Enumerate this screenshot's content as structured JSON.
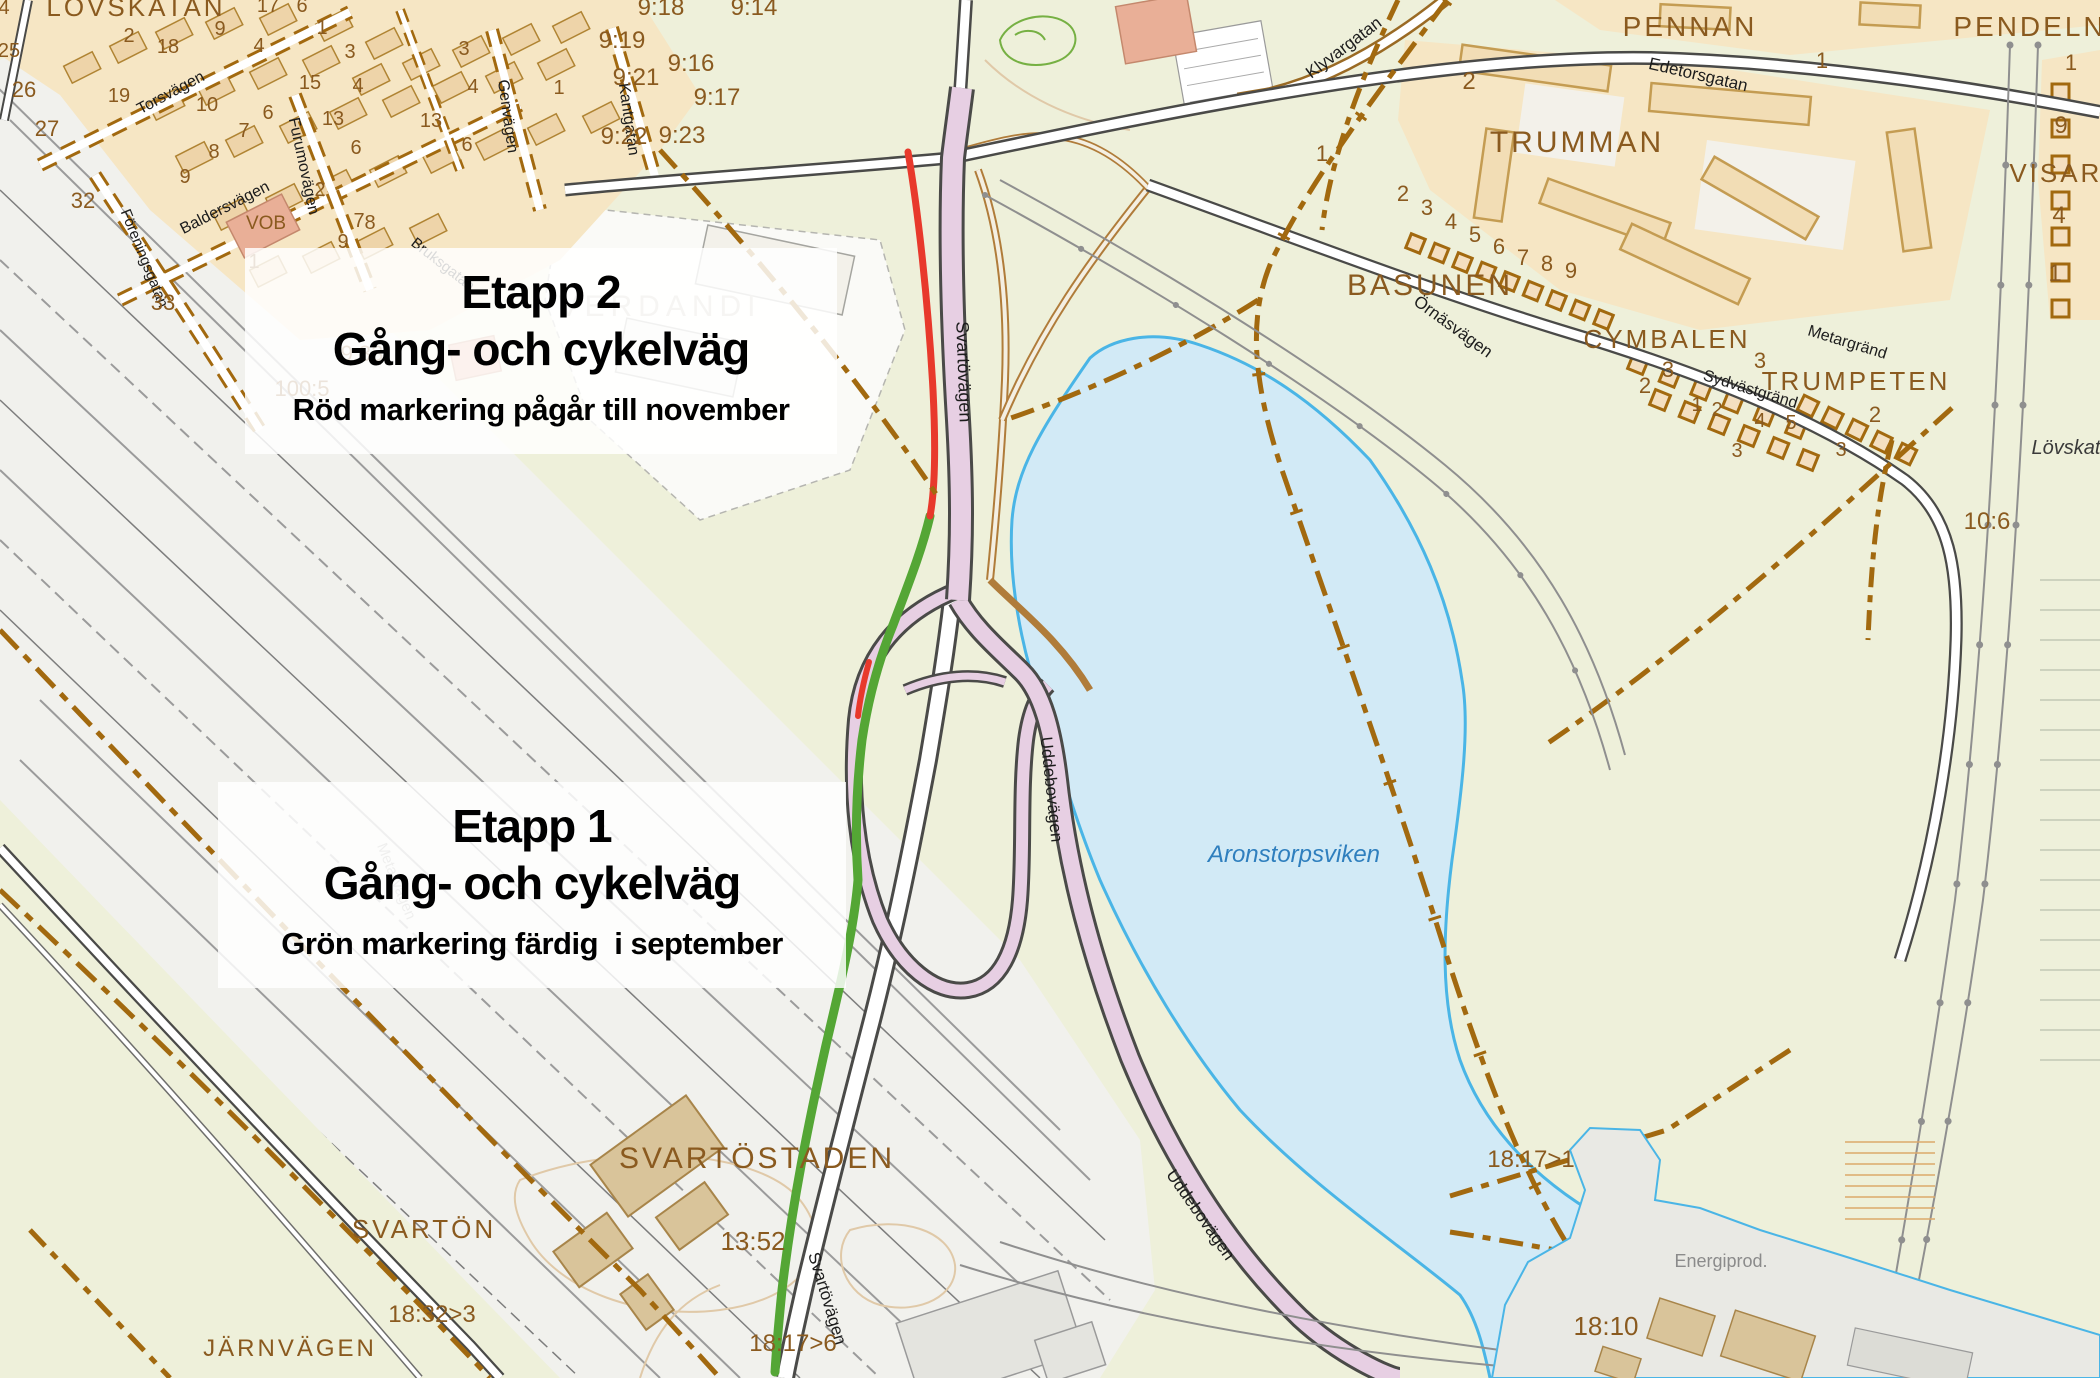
{
  "etapp2_box": {
    "title": "Etapp 2",
    "subtitle": "Gång- och cykelväg",
    "detail": "Röd markering pågår till november"
  },
  "etapp1_box": {
    "title": "Etapp 1",
    "subtitle": "Gång- och cykelväg",
    "detail": "Grön markering färdig  i september"
  },
  "markings": {
    "etapp1_green": "#54a635",
    "etapp2_red": "#e8392c",
    "water_fill": "#d2eaf6",
    "water_edge": "#4ab5e6",
    "road_pink": "#e7cfe3",
    "cadastral_brown": "#a2690f"
  },
  "map": {
    "labels": [
      {
        "text": "LÖVSKATAN",
        "x": 136,
        "y": 16,
        "r": 0,
        "s": 26,
        "c": "place"
      },
      {
        "text": "VERDANDI",
        "x": 660,
        "y": 316,
        "r": 0,
        "s": 30,
        "c": "place-gray"
      },
      {
        "text": "SVARTÖSTADEN",
        "x": 757,
        "y": 1168,
        "r": 0,
        "s": 30,
        "c": "place"
      },
      {
        "text": "SVARTÖN",
        "x": 424,
        "y": 1238,
        "r": 0,
        "s": 26,
        "c": "place"
      },
      {
        "text": "JÄRNVÄGEN",
        "x": 290,
        "y": 1356,
        "r": 0,
        "s": 24,
        "c": "place"
      },
      {
        "text": "TRUMMAN",
        "x": 1577,
        "y": 152,
        "r": 0,
        "s": 30,
        "c": "place"
      },
      {
        "text": "PENNAN",
        "x": 1690,
        "y": 36,
        "r": 0,
        "s": 28,
        "c": "place"
      },
      {
        "text": "PENDELN",
        "x": 2030,
        "y": 36,
        "r": 0,
        "s": 28,
        "c": "place"
      },
      {
        "text": "VISARE",
        "x": 2066,
        "y": 182,
        "r": 0,
        "s": 26,
        "c": "place"
      },
      {
        "text": "BASUNEN",
        "x": 1430,
        "y": 295,
        "r": 0,
        "s": 30,
        "c": "place"
      },
      {
        "text": "CYMBALEN",
        "x": 1667,
        "y": 348,
        "r": 0,
        "s": 26,
        "c": "place"
      },
      {
        "text": "TRUMPETEN",
        "x": 1856,
        "y": 390,
        "r": 0,
        "s": 26,
        "c": "place"
      },
      {
        "text": "Aronstorpsviken",
        "x": 1294,
        "y": 862,
        "r": 0,
        "s": 24,
        "c": "water"
      },
      {
        "text": "Energiprod.",
        "x": 1721,
        "y": 1267,
        "r": 0,
        "s": 18,
        "c": "gray"
      },
      {
        "text": "Lövskat",
        "x": 2066,
        "y": 454,
        "r": 0,
        "s": 20,
        "c": "it"
      },
      {
        "text": "Svartövägen",
        "x": 958,
        "y": 372,
        "r": 88,
        "s": 18,
        "c": "street"
      },
      {
        "text": "Svartövägen",
        "x": 822,
        "y": 1300,
        "r": 73,
        "s": 17,
        "c": "street"
      },
      {
        "text": "Uddebovägen",
        "x": 1046,
        "y": 790,
        "r": 84,
        "s": 17,
        "c": "street"
      },
      {
        "text": "Uddebovägen",
        "x": 1196,
        "y": 1218,
        "r": 55,
        "s": 17,
        "c": "street"
      },
      {
        "text": "Klyvargatan",
        "x": 1347,
        "y": 52,
        "r": -37,
        "s": 17,
        "c": "street"
      },
      {
        "text": "Edetorsgatan",
        "x": 1697,
        "y": 80,
        "r": 13,
        "s": 17,
        "c": "street"
      },
      {
        "text": "Örnäsvägen",
        "x": 1450,
        "y": 331,
        "r": 36,
        "s": 17,
        "c": "street"
      },
      {
        "text": "Metargränd",
        "x": 1846,
        "y": 347,
        "r": 17,
        "s": 16,
        "c": "street"
      },
      {
        "text": "Sydvästgränd",
        "x": 1749,
        "y": 394,
        "r": 17,
        "s": 16,
        "c": "street"
      },
      {
        "text": "Genvägen",
        "x": 503,
        "y": 117,
        "r": 82,
        "s": 16,
        "c": "street"
      },
      {
        "text": "Kantgatan",
        "x": 624,
        "y": 120,
        "r": 82,
        "s": 16,
        "c": "street"
      },
      {
        "text": "Furumovägen",
        "x": 299,
        "y": 167,
        "r": 78,
        "s": 16,
        "c": "street"
      },
      {
        "text": "Baldersvägen",
        "x": 227,
        "y": 212,
        "r": -27,
        "s": 16,
        "c": "street"
      },
      {
        "text": "Torsvägen",
        "x": 173,
        "y": 97,
        "r": -28,
        "s": 16,
        "c": "street"
      },
      {
        "text": "Föreningsgatan",
        "x": 140,
        "y": 260,
        "r": 68,
        "s": 15,
        "c": "street"
      },
      {
        "text": "Bruksgatan",
        "x": 440,
        "y": 268,
        "r": 38,
        "s": 15,
        "c": "street"
      },
      {
        "text": "Metallvägen",
        "x": 392,
        "y": 883,
        "r": 68,
        "s": 15,
        "c": "street-gray"
      },
      {
        "text": "9:18",
        "x": 661,
        "y": 15,
        "r": 0,
        "s": 24,
        "c": "parcel"
      },
      {
        "text": "9:14",
        "x": 754,
        "y": 15,
        "r": 0,
        "s": 24,
        "c": "parcel"
      },
      {
        "text": "9:19",
        "x": 622,
        "y": 48,
        "r": 0,
        "s": 24,
        "c": "parcel"
      },
      {
        "text": "9:16",
        "x": 691,
        "y": 71,
        "r": 0,
        "s": 24,
        "c": "parcel"
      },
      {
        "text": "9:21",
        "x": 636,
        "y": 85,
        "r": 0,
        "s": 24,
        "c": "parcel"
      },
      {
        "text": "9:17",
        "x": 717,
        "y": 105,
        "r": 0,
        "s": 24,
        "c": "parcel"
      },
      {
        "text": "9:22",
        "x": 624,
        "y": 144,
        "r": 0,
        "s": 24,
        "c": "parcel"
      },
      {
        "text": "9:23",
        "x": 682,
        "y": 143,
        "r": 0,
        "s": 24,
        "c": "parcel"
      },
      {
        "text": "9:33",
        "x": 362,
        "y": 361,
        "r": 0,
        "s": 22,
        "c": "parcel"
      },
      {
        "text": "100:5",
        "x": 302,
        "y": 396,
        "r": 0,
        "s": 22,
        "c": "parcel"
      },
      {
        "text": "33",
        "x": 163,
        "y": 310,
        "r": 0,
        "s": 22,
        "c": "parcel"
      },
      {
        "text": "10:6",
        "x": 1987,
        "y": 529,
        "r": 0,
        "s": 24,
        "c": "parcel"
      },
      {
        "text": "13:52",
        "x": 753,
        "y": 1250,
        "r": 0,
        "s": 26,
        "c": "parcel"
      },
      {
        "text": "18:32>3",
        "x": 432,
        "y": 1322,
        "r": 0,
        "s": 24,
        "c": "parcel"
      },
      {
        "text": "18:17>1",
        "x": 1531,
        "y": 1167,
        "r": 0,
        "s": 24,
        "c": "parcel"
      },
      {
        "text": "18:10",
        "x": 1606,
        "y": 1335,
        "r": 0,
        "s": 26,
        "c": "parcel"
      },
      {
        "text": "18:17>6",
        "x": 793,
        "y": 1351,
        "r": 0,
        "s": 24,
        "c": "parcel"
      },
      {
        "text": "VOB",
        "x": 266,
        "y": 229,
        "r": 0,
        "s": 19,
        "c": "num"
      },
      {
        "text": "4",
        "x": 4,
        "y": 14,
        "r": 0,
        "s": 20,
        "c": "num"
      },
      {
        "text": "25",
        "x": 9,
        "y": 57,
        "r": 0,
        "s": 20,
        "c": "num"
      },
      {
        "text": "26",
        "x": 24,
        "y": 97,
        "r": 0,
        "s": 22,
        "c": "num"
      },
      {
        "text": "27",
        "x": 47,
        "y": 136,
        "r": 0,
        "s": 22,
        "c": "num"
      },
      {
        "text": "32",
        "x": 83,
        "y": 208,
        "r": 0,
        "s": 22,
        "c": "num"
      },
      {
        "text": "19",
        "x": 119,
        "y": 102,
        "r": 0,
        "s": 20,
        "c": "num"
      },
      {
        "text": "2",
        "x": 129,
        "y": 42,
        "r": 0,
        "s": 20,
        "c": "num"
      },
      {
        "text": "18",
        "x": 168,
        "y": 53,
        "r": 0,
        "s": 20,
        "c": "num"
      },
      {
        "text": "17",
        "x": 268,
        "y": 12,
        "r": 0,
        "s": 20,
        "c": "num"
      },
      {
        "text": "6",
        "x": 302,
        "y": 12,
        "r": 0,
        "s": 20,
        "c": "num"
      },
      {
        "text": "9",
        "x": 220,
        "y": 35,
        "r": 0,
        "s": 20,
        "c": "num"
      },
      {
        "text": "1",
        "x": 322,
        "y": 34,
        "r": 0,
        "s": 20,
        "c": "num"
      },
      {
        "text": "3",
        "x": 350,
        "y": 58,
        "r": 0,
        "s": 20,
        "c": "num"
      },
      {
        "text": "4",
        "x": 259,
        "y": 52,
        "r": 0,
        "s": 20,
        "c": "num"
      },
      {
        "text": "10",
        "x": 207,
        "y": 111,
        "r": 0,
        "s": 20,
        "c": "num"
      },
      {
        "text": "15",
        "x": 310,
        "y": 89,
        "r": 0,
        "s": 20,
        "c": "num"
      },
      {
        "text": "4",
        "x": 358,
        "y": 92,
        "r": 0,
        "s": 20,
        "c": "num"
      },
      {
        "text": "13",
        "x": 333,
        "y": 125,
        "r": 0,
        "s": 20,
        "c": "num"
      },
      {
        "text": "6",
        "x": 268,
        "y": 119,
        "r": 0,
        "s": 20,
        "c": "num"
      },
      {
        "text": "7",
        "x": 244,
        "y": 137,
        "r": 0,
        "s": 20,
        "c": "num"
      },
      {
        "text": "6",
        "x": 356,
        "y": 154,
        "r": 0,
        "s": 20,
        "c": "num"
      },
      {
        "text": "8",
        "x": 214,
        "y": 158,
        "r": 0,
        "s": 20,
        "c": "num"
      },
      {
        "text": "9",
        "x": 185,
        "y": 183,
        "r": 0,
        "s": 20,
        "c": "num"
      },
      {
        "text": "2",
        "x": 320,
        "y": 196,
        "r": 0,
        "s": 20,
        "c": "num"
      },
      {
        "text": "7",
        "x": 359,
        "y": 227,
        "r": 0,
        "s": 20,
        "c": "num"
      },
      {
        "text": "8",
        "x": 370,
        "y": 229,
        "r": 0,
        "s": 20,
        "c": "num"
      },
      {
        "text": "9",
        "x": 343,
        "y": 248,
        "r": 0,
        "s": 20,
        "c": "num"
      },
      {
        "text": "1",
        "x": 254,
        "y": 268,
        "r": 0,
        "s": 20,
        "c": "num"
      },
      {
        "text": "3",
        "x": 464,
        "y": 55,
        "r": 0,
        "s": 20,
        "c": "num"
      },
      {
        "text": "4",
        "x": 473,
        "y": 93,
        "r": 0,
        "s": 20,
        "c": "num"
      },
      {
        "text": "13",
        "x": 431,
        "y": 127,
        "r": 0,
        "s": 20,
        "c": "num"
      },
      {
        "text": "6",
        "x": 467,
        "y": 151,
        "r": 0,
        "s": 20,
        "c": "num"
      },
      {
        "text": "1",
        "x": 559,
        "y": 94,
        "r": 0,
        "s": 20,
        "c": "num"
      },
      {
        "text": "2",
        "x": 1469,
        "y": 89,
        "r": 0,
        "s": 24,
        "c": "num"
      },
      {
        "text": "1",
        "x": 1822,
        "y": 68,
        "r": 0,
        "s": 22,
        "c": "num"
      },
      {
        "text": "1",
        "x": 2071,
        "y": 70,
        "r": 0,
        "s": 22,
        "c": "num"
      },
      {
        "text": "9",
        "x": 2061,
        "y": 133,
        "r": 0,
        "s": 24,
        "c": "num"
      },
      {
        "text": "4",
        "x": 2059,
        "y": 223,
        "r": 0,
        "s": 24,
        "c": "num"
      },
      {
        "text": "1",
        "x": 2055,
        "y": 281,
        "r": 0,
        "s": 24,
        "c": "num"
      },
      {
        "text": "1",
        "x": 1322,
        "y": 161,
        "r": 0,
        "s": 22,
        "c": "num"
      },
      {
        "text": "2",
        "x": 1403,
        "y": 201,
        "r": 0,
        "s": 22,
        "c": "num"
      },
      {
        "text": "3",
        "x": 1427,
        "y": 215,
        "r": 0,
        "s": 22,
        "c": "num"
      },
      {
        "text": "4",
        "x": 1451,
        "y": 229,
        "r": 0,
        "s": 22,
        "c": "num"
      },
      {
        "text": "5",
        "x": 1475,
        "y": 242,
        "r": 0,
        "s": 22,
        "c": "num"
      },
      {
        "text": "6",
        "x": 1499,
        "y": 254,
        "r": 0,
        "s": 22,
        "c": "num"
      },
      {
        "text": "7",
        "x": 1523,
        "y": 265,
        "r": 0,
        "s": 22,
        "c": "num"
      },
      {
        "text": "8",
        "x": 1547,
        "y": 271,
        "r": 0,
        "s": 22,
        "c": "num"
      },
      {
        "text": "9",
        "x": 1571,
        "y": 278,
        "r": 0,
        "s": 22,
        "c": "num"
      },
      {
        "text": "3",
        "x": 1668,
        "y": 377,
        "r": 0,
        "s": 22,
        "c": "num"
      },
      {
        "text": "2",
        "x": 1645,
        "y": 393,
        "r": 0,
        "s": 22,
        "c": "num"
      },
      {
        "text": "3",
        "x": 1760,
        "y": 368,
        "r": 0,
        "s": 22,
        "c": "num"
      },
      {
        "text": "1",
        "x": 1697,
        "y": 411,
        "r": 0,
        "s": 20,
        "c": "num"
      },
      {
        "text": "2",
        "x": 1717,
        "y": 416,
        "r": 0,
        "s": 20,
        "c": "num"
      },
      {
        "text": "4",
        "x": 1760,
        "y": 427,
        "r": 0,
        "s": 20,
        "c": "num"
      },
      {
        "text": "5",
        "x": 1791,
        "y": 429,
        "r": 0,
        "s": 20,
        "c": "num"
      },
      {
        "text": "3",
        "x": 1737,
        "y": 457,
        "r": 0,
        "s": 20,
        "c": "num"
      },
      {
        "text": "3",
        "x": 1841,
        "y": 456,
        "r": 0,
        "s": 20,
        "c": "num"
      },
      {
        "text": "2",
        "x": 1875,
        "y": 422,
        "r": 0,
        "s": 22,
        "c": "num"
      }
    ]
  }
}
